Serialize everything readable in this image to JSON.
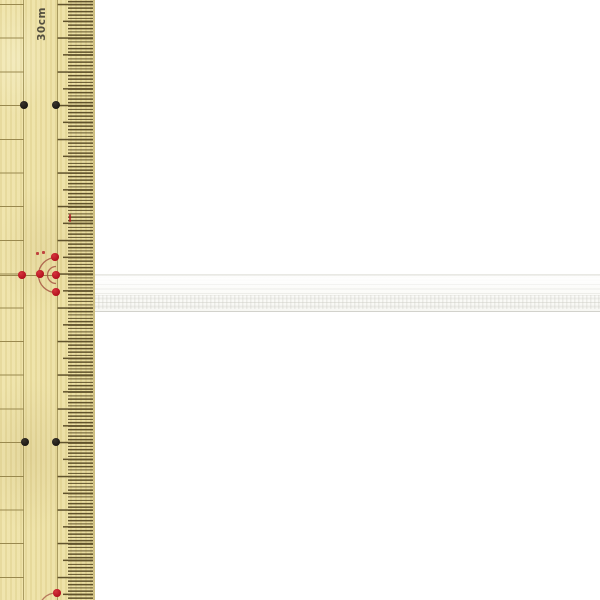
{
  "colors": {
    "background": "#ffffff",
    "wood": "#ecdfa0",
    "tick": "#60522c",
    "grid_line": "#99894f",
    "label_text": "#555040",
    "marker_black": "#1c1814",
    "marker_red": "#b3121f",
    "arc_red": "#a34f3e",
    "tape_white": "#fbfbf8",
    "tape_rib": "#d0d0c8"
  },
  "ruler": {
    "label": "30cm",
    "orientation": "vertical",
    "ticks": {
      "cm_spacing_px": 33.7,
      "mm_spacing_px": 3.37
    },
    "markers": {
      "black_dots": [
        {
          "x": 24,
          "y": 105
        },
        {
          "x": 56,
          "y": 105
        },
        {
          "x": 25,
          "y": 442
        },
        {
          "x": 56,
          "y": 442
        }
      ],
      "red_dots": [
        {
          "x": 55,
          "y": 257
        },
        {
          "x": 22,
          "y": 275
        },
        {
          "x": 40,
          "y": 274
        },
        {
          "x": 56,
          "y": 275
        },
        {
          "x": 56,
          "y": 292
        },
        {
          "x": 57,
          "y": 593
        }
      ],
      "red_specks": [
        {
          "x": 37,
          "y": 253,
          "w": 3,
          "h": 3
        },
        {
          "x": 43,
          "y": 252,
          "w": 3,
          "h": 3
        },
        {
          "x": 70,
          "y": 218,
          "w": 2,
          "h": 8
        }
      ]
    }
  },
  "tape": {
    "kind": "white woven elastic tape",
    "color": "#fbfbf8"
  }
}
